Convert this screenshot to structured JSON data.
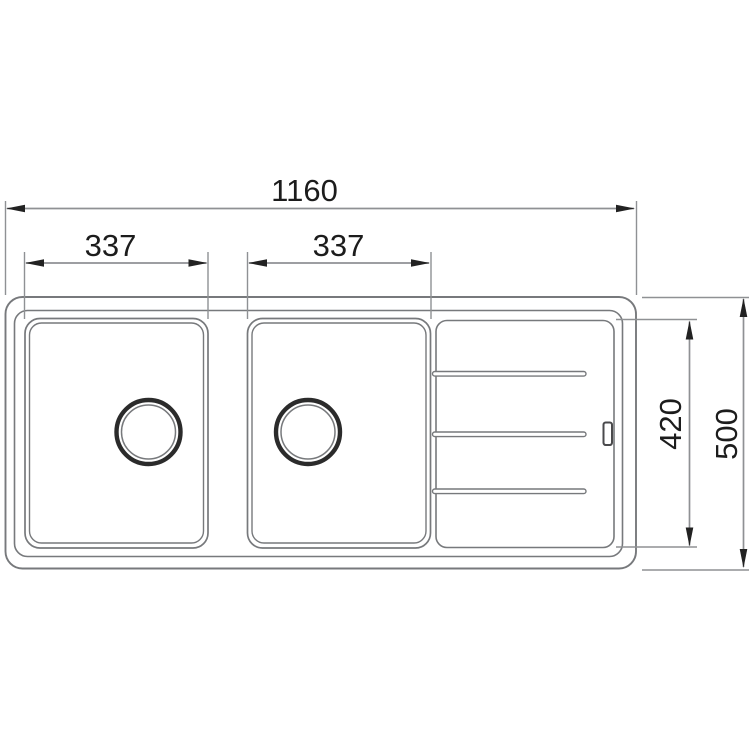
{
  "drawing": {
    "type": "sink-technical-drawing-top-view",
    "dimensions": {
      "overall_width": "1160",
      "left_bowl_width": "337",
      "right_bowl_width": "337",
      "inner_depth": "420",
      "overall_depth": "500"
    },
    "colors": {
      "background": "#ffffff",
      "outline": "#77797c",
      "dim_line": "#8f9194",
      "witness_line": "#8f9194",
      "arrow": "#222222",
      "text": "#1c1c1c",
      "drain_ring": "#2b2b2b",
      "slot": "#4a4a4c"
    }
  }
}
